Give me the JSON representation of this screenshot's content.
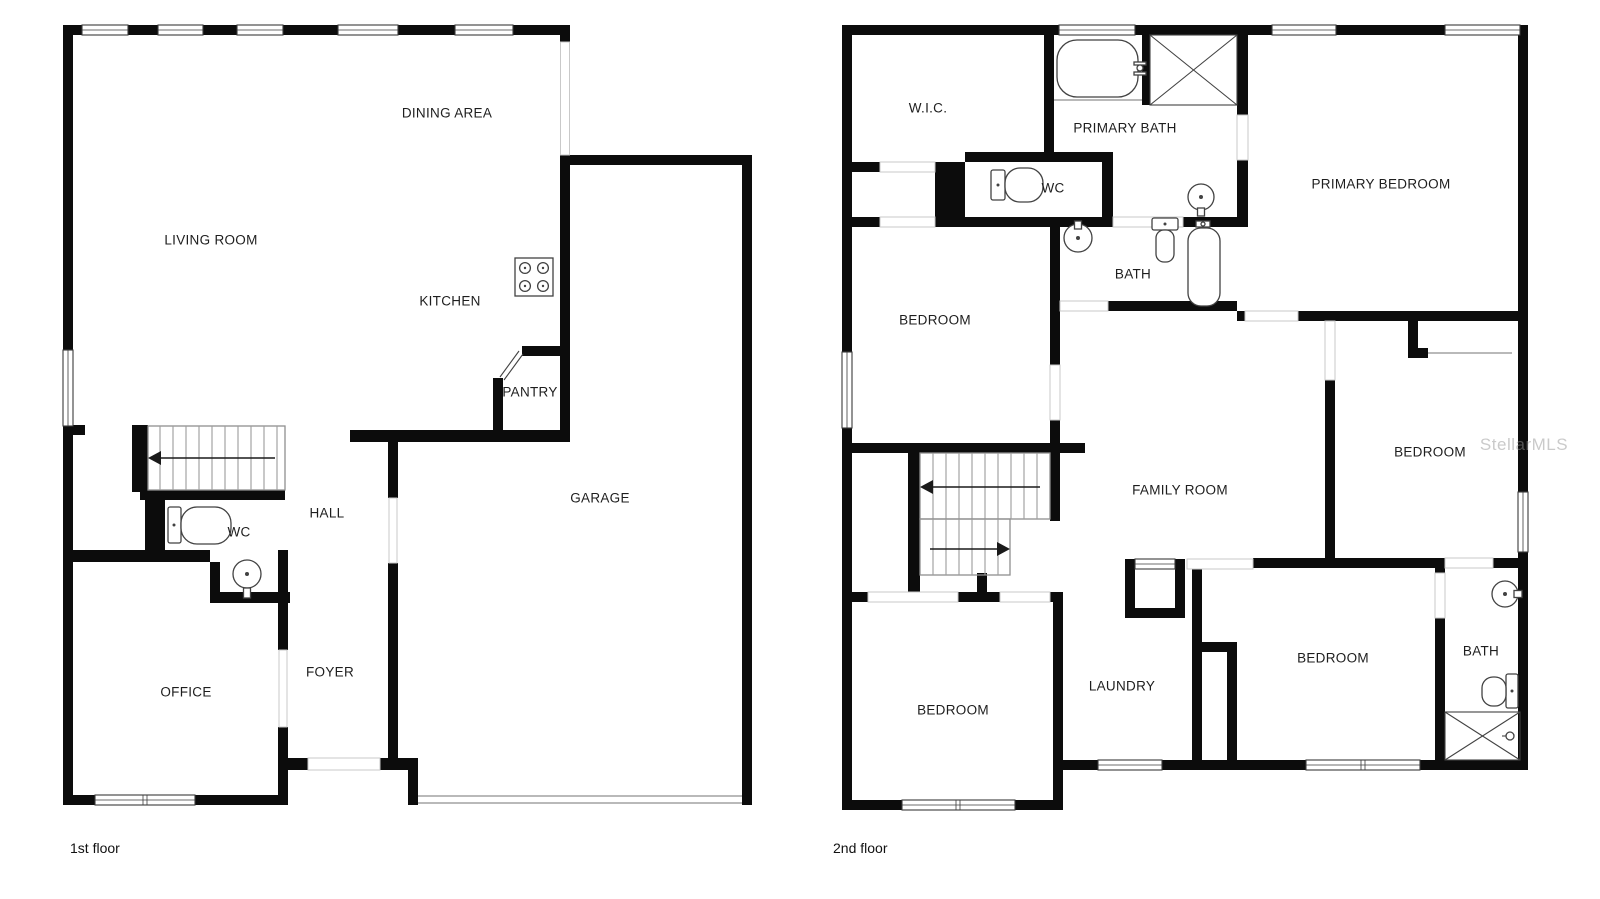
{
  "page": {
    "background": "#ffffff"
  },
  "colors": {
    "wall": "#0c0c0c",
    "thin_line": "#8f8f8f",
    "opening_line": "#c9c9c9",
    "fixture_line": "#424242",
    "label_text": "#1e1e1e",
    "watermark_text": "#969696"
  },
  "watermark": {
    "text": "StellarMLS"
  },
  "icons": {
    "stove": "stove-icon",
    "toilet": "toilet-icon",
    "sink": "sink-icon",
    "bathtub": "bathtub-icon",
    "shower": "shower-icon",
    "stairs": "stairs-icon",
    "window": "window",
    "door": "door-opening"
  },
  "floors": [
    {
      "id": "first",
      "caption": "1st floor",
      "rooms": [
        {
          "id": "living-room",
          "label": "LIVING ROOM"
        },
        {
          "id": "dining-area",
          "label": "DINING AREA"
        },
        {
          "id": "kitchen",
          "label": "KITCHEN"
        },
        {
          "id": "pantry",
          "label": "PANTRY"
        },
        {
          "id": "hall",
          "label": "HALL"
        },
        {
          "id": "wc",
          "label": "WC"
        },
        {
          "id": "foyer",
          "label": "FOYER"
        },
        {
          "id": "office",
          "label": "OFFICE"
        },
        {
          "id": "garage",
          "label": "GARAGE"
        }
      ]
    },
    {
      "id": "second",
      "caption": "2nd floor",
      "rooms": [
        {
          "id": "wic",
          "label": "W.I.C."
        },
        {
          "id": "primary-bath",
          "label": "PRIMARY BATH"
        },
        {
          "id": "wc",
          "label": "WC"
        },
        {
          "id": "primary-bedroom",
          "label": "PRIMARY BEDROOM"
        },
        {
          "id": "bath-middle",
          "label": "BATH"
        },
        {
          "id": "bedroom-upper-left",
          "label": "BEDROOM"
        },
        {
          "id": "family-room",
          "label": "FAMILY ROOM"
        },
        {
          "id": "bedroom-right",
          "label": "BEDROOM"
        },
        {
          "id": "bedroom-lower-left",
          "label": "BEDROOM"
        },
        {
          "id": "laundry",
          "label": "LAUNDRY"
        },
        {
          "id": "bedroom-middle",
          "label": "BEDROOM"
        },
        {
          "id": "bath-lower",
          "label": "BATH"
        }
      ]
    }
  ]
}
